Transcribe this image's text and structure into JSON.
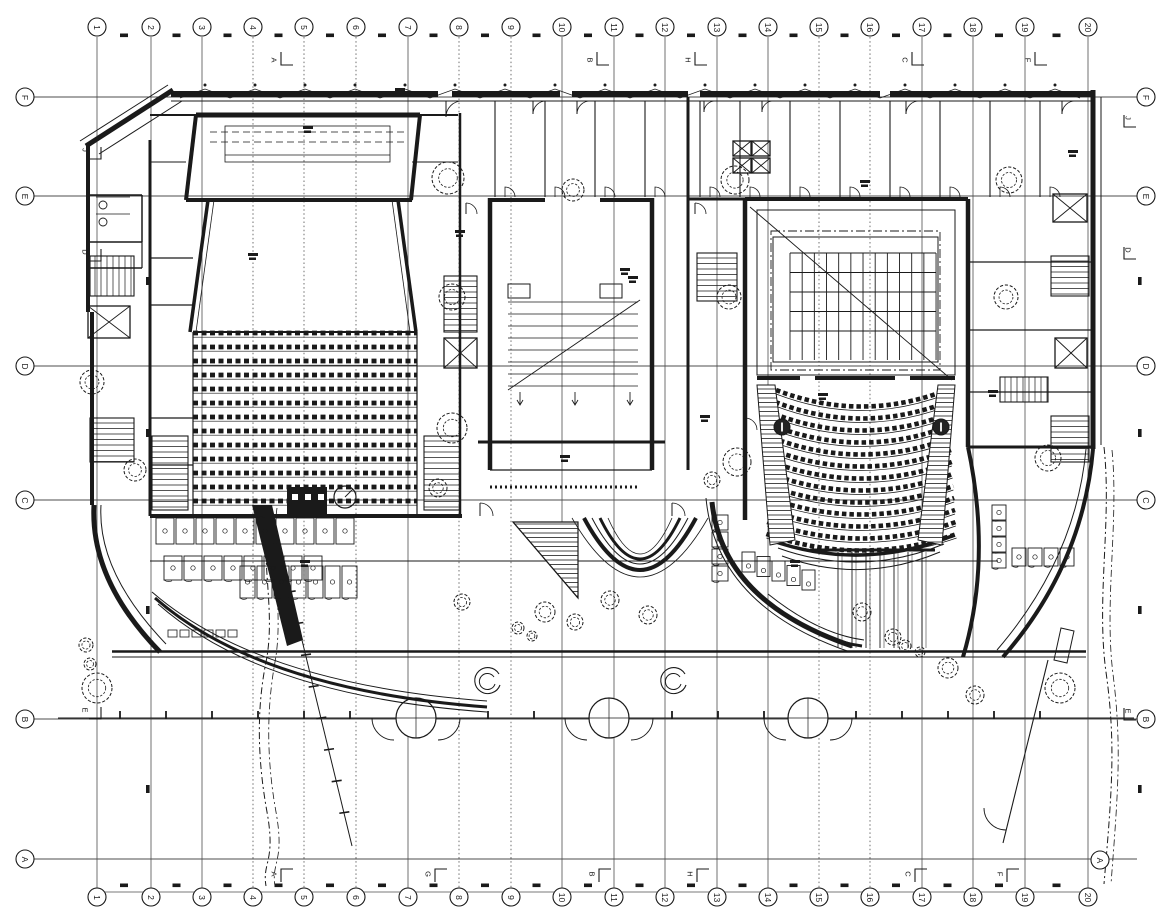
{
  "drawing": {
    "background": "#ffffff",
    "ink": "#1a1a1a",
    "grid_color": "#4d4d4d",
    "bubble_radius": 9,
    "grid": {
      "columns": [
        {
          "label": "1",
          "x": 97
        },
        {
          "label": "2",
          "x": 151
        },
        {
          "label": "3",
          "x": 202
        },
        {
          "label": "4",
          "x": 253
        },
        {
          "label": "5",
          "x": 304
        },
        {
          "label": "6",
          "x": 356
        },
        {
          "label": "7",
          "x": 408
        },
        {
          "label": "8",
          "x": 459
        },
        {
          "label": "9",
          "x": 511
        },
        {
          "label": "10",
          "x": 562
        },
        {
          "label": "11",
          "x": 614
        },
        {
          "label": "12",
          "x": 665
        },
        {
          "label": "13",
          "x": 717
        },
        {
          "label": "14",
          "x": 768
        },
        {
          "label": "15",
          "x": 819
        },
        {
          "label": "16",
          "x": 870
        },
        {
          "label": "17",
          "x": 922
        },
        {
          "label": "18",
          "x": 973
        },
        {
          "label": "19",
          "x": 1025
        },
        {
          "label": "20",
          "x": 1088
        }
      ],
      "dashed_columns": [
        "4",
        "5",
        "6",
        "8",
        "9",
        "15",
        "16"
      ],
      "rows": [
        {
          "label": "F",
          "y": 97
        },
        {
          "label": "E",
          "y": 196
        },
        {
          "label": "D",
          "y": 366
        },
        {
          "label": "C",
          "y": 500
        },
        {
          "label": "B",
          "y": 719
        },
        {
          "label": "A",
          "y": 859
        }
      ],
      "top_bubble_y": 27,
      "bottom_bubble_y": 897,
      "left_bubble_x": 25,
      "right_bubble_x": 1146,
      "right_bubble_A": {
        "x": 1100,
        "y": 860
      }
    },
    "section_markers": {
      "top": [
        {
          "label": "A",
          "x": 274
        },
        {
          "label": "B",
          "x": 590
        },
        {
          "label": "H",
          "x": 688
        },
        {
          "label": "C",
          "x": 905
        },
        {
          "label": "F",
          "x": 1028
        }
      ],
      "bottom": [
        {
          "label": "A",
          "x": 274
        },
        {
          "label": "G",
          "x": 428
        },
        {
          "label": "B",
          "x": 592
        },
        {
          "label": "H",
          "x": 690
        },
        {
          "label": "C",
          "x": 908
        },
        {
          "label": "F",
          "x": 1000
        }
      ],
      "left": [
        {
          "label": "J",
          "y": 150
        },
        {
          "label": "D",
          "y": 252
        },
        {
          "label": "E",
          "y": 710
        }
      ],
      "right": [
        {
          "label": "J",
          "y": 118
        },
        {
          "label": "D",
          "y": 250
        },
        {
          "label": "E",
          "y": 711
        }
      ]
    }
  }
}
